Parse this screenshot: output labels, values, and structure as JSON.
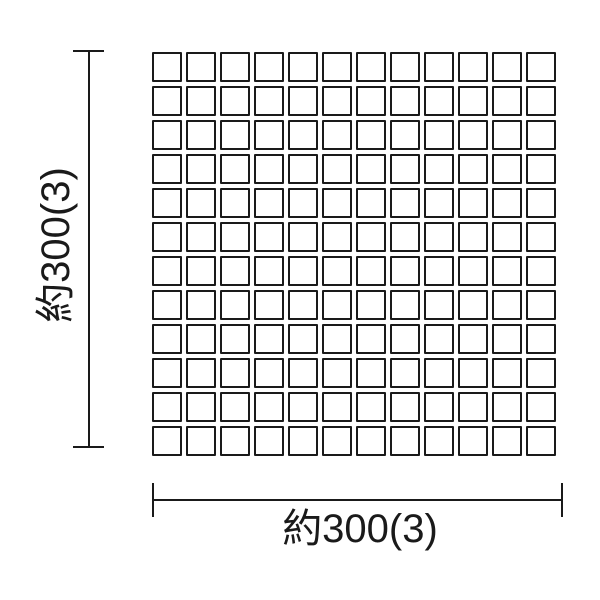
{
  "diagram": {
    "kind": "tile-sheet-dimension-drawing",
    "background_color": "#ffffff",
    "line_color": "#1a1a1a",
    "grid": {
      "rows": 12,
      "columns": 12,
      "tile_count": 144,
      "tile_fill_color": "#ffffff",
      "tile_border_color": "#1a1a1a"
    },
    "dimensions": {
      "vertical": {
        "label": "約300(3)"
      },
      "horizontal": {
        "label": "約300(3)"
      }
    }
  }
}
